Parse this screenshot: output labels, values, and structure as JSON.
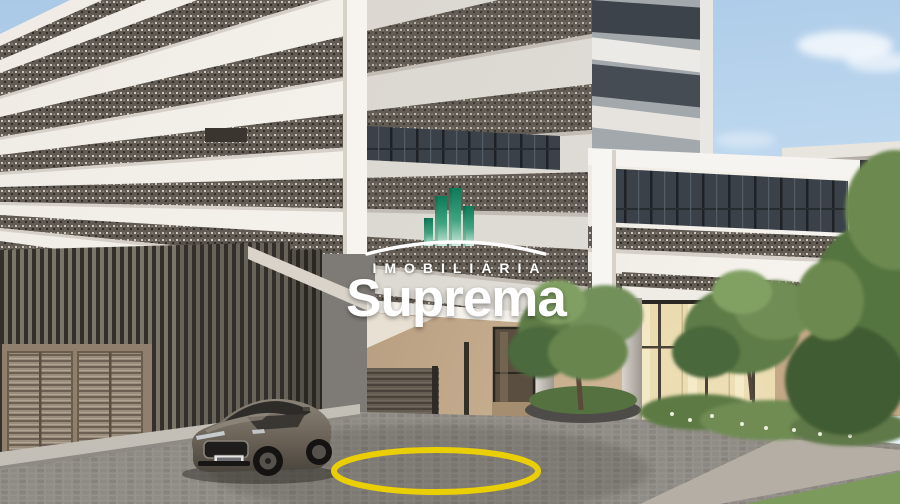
{
  "watermark": {
    "label": "IMOBILIÁRIA",
    "name": "Suprema",
    "icon": "buildings-logo-icon",
    "colors": {
      "text": "#ffffff",
      "green_dark": "#0d7a58",
      "green_light": "#cfeadd"
    }
  },
  "scene": {
    "kind": "architectural-render",
    "road_marking_color": "#f0d400",
    "sky_top_color": "#a9c9e7",
    "sky_bottom_color": "#e8f3fb",
    "elements": [
      "residential-tower",
      "white-banded-podium",
      "garage-slat-wall",
      "louvered-garage-doors",
      "entrance-lobby-glass",
      "landscaped-trees",
      "cobblestone-driveway",
      "parked-sedan-car",
      "yellow-circle-road-marking"
    ]
  }
}
